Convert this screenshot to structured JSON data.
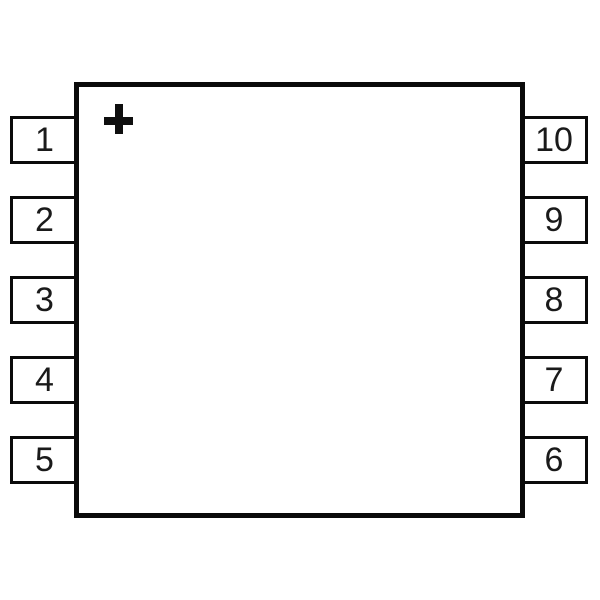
{
  "diagram": {
    "type": "ic-package-pinout-top-view",
    "orientation_marker": "+",
    "colors": {
      "line": "#0a0a0a",
      "background": "#ffffff",
      "text": "#1a1a1a"
    },
    "pins": {
      "left": [
        {
          "number": "1"
        },
        {
          "number": "2"
        },
        {
          "number": "3"
        },
        {
          "number": "4"
        },
        {
          "number": "5"
        }
      ],
      "right": [
        {
          "number": "10"
        },
        {
          "number": "9"
        },
        {
          "number": "8"
        },
        {
          "number": "7"
        },
        {
          "number": "6"
        }
      ]
    }
  }
}
